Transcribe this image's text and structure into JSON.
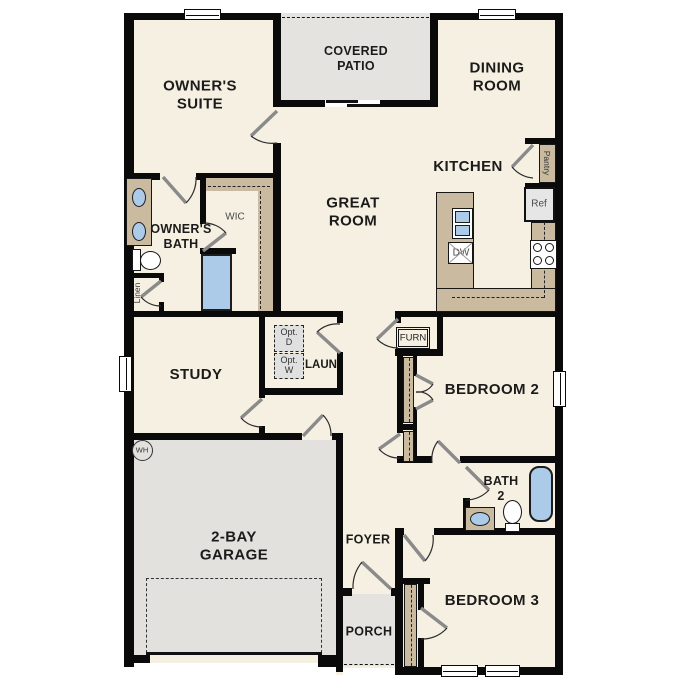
{
  "plan": {
    "colors": {
      "walls": "#0a0a0a",
      "floor": "#f6f0e2",
      "patio": "#e4e3e0",
      "garage": "#e2e1de",
      "counter_tan": "#c9baa0",
      "fixture_blue": "#abcbe9",
      "opt_box": "#e0e0e0",
      "ref_box": "#e6e6e6",
      "label_dark": "#1b1b1b",
      "label_grey": "#4a4a4a"
    },
    "rooms": {
      "owners_suite": {
        "line1": "OWNER'S",
        "line2": "SUITE"
      },
      "covered_patio": {
        "line1": "COVERED",
        "line2": "PATIO"
      },
      "dining_room": {
        "line1": "DINING",
        "line2": "ROOM"
      },
      "kitchen": {
        "label": "KITCHEN"
      },
      "great_room": {
        "line1": "GREAT",
        "line2": "ROOM"
      },
      "owners_bath": {
        "line1": "OWNER'S",
        "line2": "BATH"
      },
      "wic": {
        "label": "WIC"
      },
      "study": {
        "label": "STUDY"
      },
      "laundry": {
        "label": "LAUN"
      },
      "bedroom2": {
        "label": "BEDROOM 2"
      },
      "bath2": {
        "line1": "BATH",
        "line2": "2"
      },
      "bedroom3": {
        "label": "BEDROOM 3"
      },
      "garage": {
        "line1": "2-BAY",
        "line2": "GARAGE"
      },
      "foyer": {
        "label": "FOYER"
      },
      "porch": {
        "label": "PORCH"
      }
    },
    "fixtures": {
      "pantry": "Pantry",
      "ref": "Ref",
      "dw": "DW",
      "furn": "FURN",
      "wh": "WH",
      "linen": "Linen",
      "opt_d_line1": "Opt.",
      "opt_d_line2": "D",
      "opt_w_line1": "Opt.",
      "opt_w_line2": "W"
    }
  }
}
